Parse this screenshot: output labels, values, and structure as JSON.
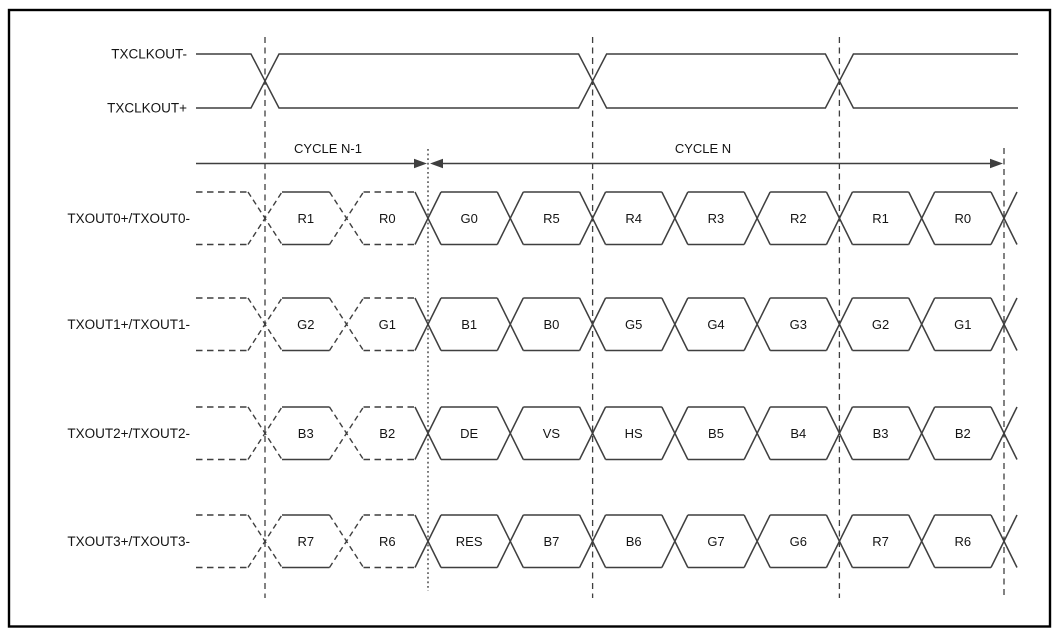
{
  "figure": {
    "clock": {
      "minus_label": "TXCLKOUT-",
      "plus_label": "TXCLKOUT+"
    },
    "cycles": {
      "prev_label": "CYCLE N-1",
      "current_label": "CYCLE N"
    },
    "lanes": [
      {
        "label": "TXOUT0+/TXOUT0-",
        "prev_cycle_bits": [
          "R1",
          "R0"
        ],
        "cycle_bits": [
          "G0",
          "R5",
          "R4",
          "R3",
          "R2",
          "R1",
          "R0"
        ]
      },
      {
        "label": "TXOUT1+/TXOUT1-",
        "prev_cycle_bits": [
          "G2",
          "G1"
        ],
        "cycle_bits": [
          "B1",
          "B0",
          "G5",
          "G4",
          "G3",
          "G2",
          "G1"
        ]
      },
      {
        "label": "TXOUT2+/TXOUT2-",
        "prev_cycle_bits": [
          "B3",
          "B2"
        ],
        "cycle_bits": [
          "DE",
          "VS",
          "HS",
          "B5",
          "B4",
          "B3",
          "B2"
        ]
      },
      {
        "label": "TXOUT3+/TXOUT3-",
        "prev_cycle_bits": [
          "R7",
          "R6"
        ],
        "cycle_bits": [
          "RES",
          "B7",
          "B6",
          "G7",
          "G6",
          "R7",
          "R6"
        ]
      }
    ],
    "colors": {
      "line": "#3f3f3f",
      "text": "#141414",
      "border": "#000000",
      "background": "#ffffff"
    }
  }
}
